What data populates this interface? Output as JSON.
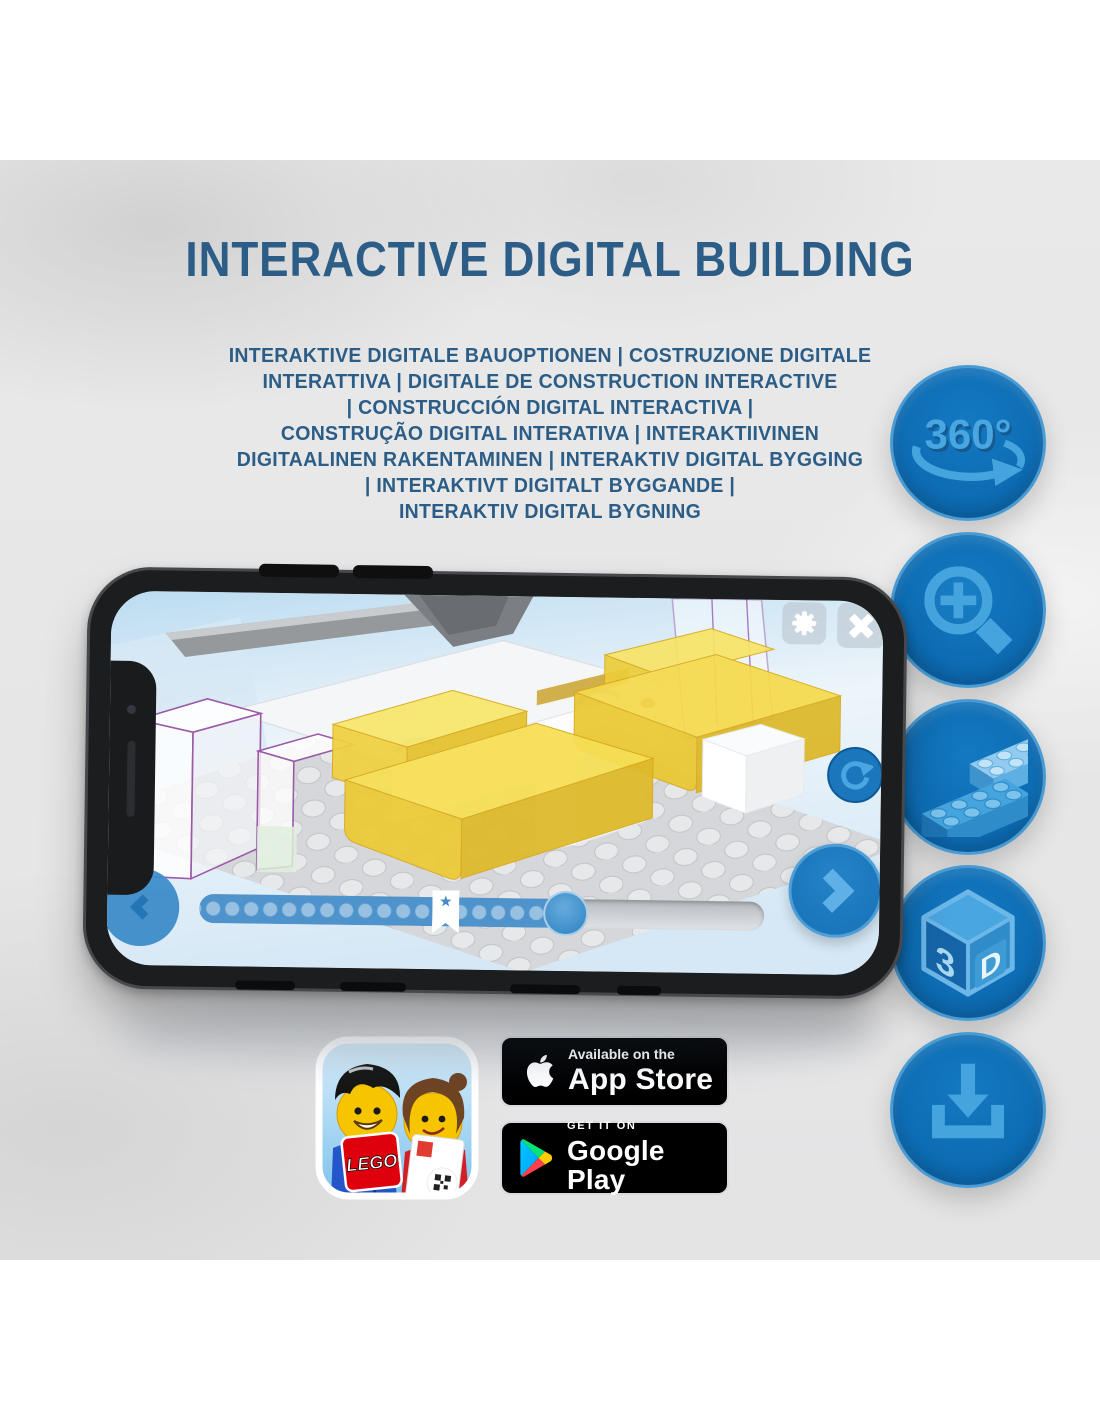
{
  "header": {
    "title": "INTERACTIVE DIGITAL BUILDING"
  },
  "subtitle": {
    "lines": [
      "INTERAKTIVE DIGITALE BAUOPTIONEN | COSTRUZIONE DIGITALE",
      "INTERATTIVA | DIGITALE DE CONSTRUCTION INTERACTIVE",
      "| CONSTRUCCIÓN DIGITAL INTERACTIVA |",
      "CONSTRUÇÃO DIGITAL INTERATIVA | INTERAKTIIVINEN",
      "DIGITAALINEN RAKENTAMINEN | INTERAKTIV DIGITAL BYGGING",
      "| INTERAKTIVT DIGITALT BYGGANDE |",
      "INTERAKTIV DIGITAL BYGNING"
    ]
  },
  "feature_icons": {
    "rotate_360": {
      "label": "360°"
    },
    "cube_3d": {
      "left": "3",
      "right": "D"
    }
  },
  "phone_app": {
    "bookmark_star": "★"
  },
  "store_badges": {
    "app_store": {
      "line1": "Available on the",
      "line2": "App Store"
    },
    "google_play": {
      "line1": "GET IT ON",
      "line2": "Google Play"
    }
  },
  "lego_app_icon": {
    "logo_text": "LEGO"
  },
  "colors": {
    "title_blue": "#2b5d87",
    "feature_circle_blue": "#0e6db4",
    "feature_glyph_blue": "#45a4de",
    "screen_button_blue": "#1b76bb",
    "slider_fill_blue": "#4e93cc",
    "brick_yellow": "#f5da4c",
    "lego_red": "#df000d"
  }
}
